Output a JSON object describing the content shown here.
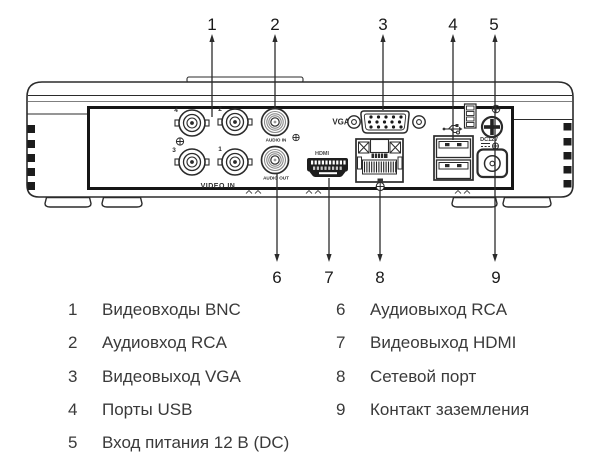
{
  "callouts": {
    "top": [
      "1",
      "2",
      "3",
      "4",
      "5"
    ],
    "bottom": [
      "6",
      "7",
      "8",
      "9"
    ]
  },
  "device_labels": {
    "bnc4": "4",
    "bnc2": "2",
    "bnc3": "3",
    "bnc1": "1",
    "video_in": "VIDEO IN",
    "audio_in": "AUDIO IN",
    "audio_out": "AUDIO OUT",
    "vga": "VGA",
    "hdmi": "HDMI",
    "dc": "DC12V"
  },
  "icons": {
    "usb_symbol": "usb-trident",
    "ground_screw": "phillips-screw",
    "small_screws": "crosshair-screw"
  },
  "legend": {
    "left": [
      {
        "num": "1",
        "label": "Видеовходы BNC"
      },
      {
        "num": "2",
        "label": "Аудиовход RCA"
      },
      {
        "num": "3",
        "label": "Видеовыход VGA"
      },
      {
        "num": "4",
        "label": "Порты USB"
      },
      {
        "num": "5",
        "label": "Вход питания 12 В (DC)"
      }
    ],
    "right": [
      {
        "num": "6",
        "label": "Аудиовыход RCA"
      },
      {
        "num": "7",
        "label": "Видеовыход HDMI"
      },
      {
        "num": "8",
        "label": "Сетевой порт"
      },
      {
        "num": "9",
        "label": "Контакт заземления"
      }
    ]
  },
  "colors": {
    "line": "#2b2b2b",
    "panel_border": "#151515",
    "text": "#3a3a3a",
    "number": "#1a1a1a"
  }
}
